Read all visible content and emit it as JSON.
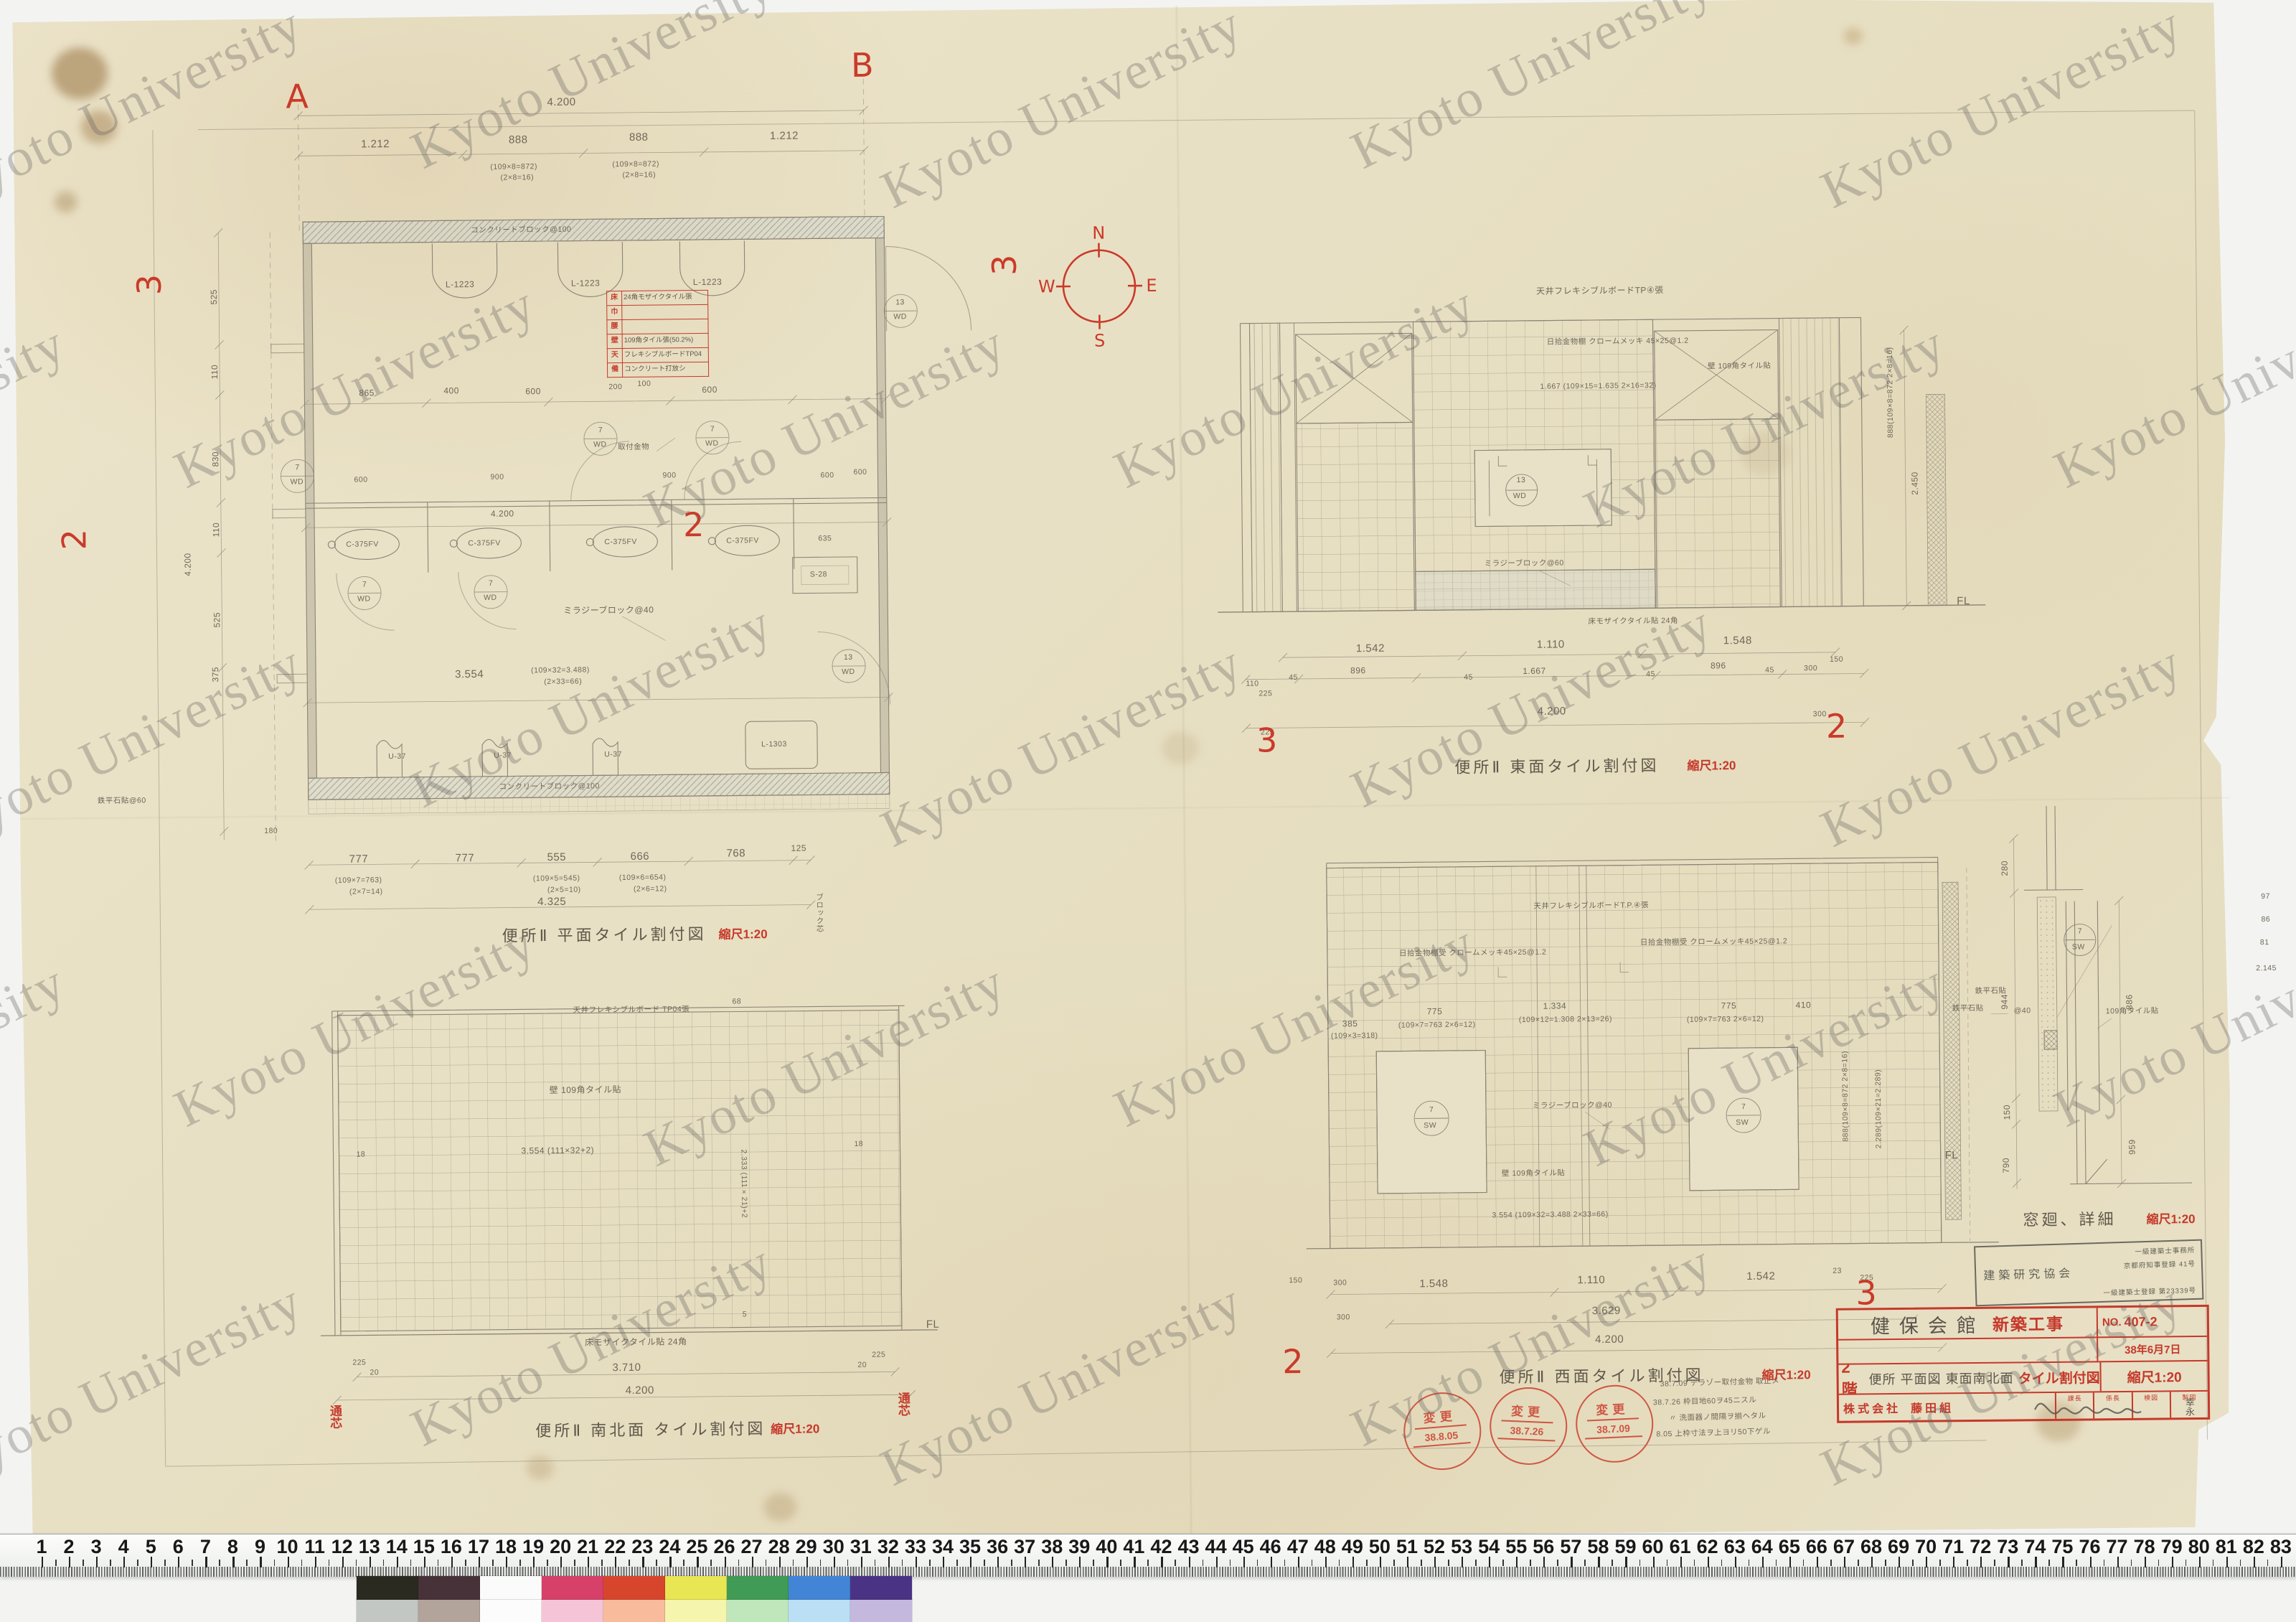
{
  "watermark": {
    "text": "Kyoto University"
  },
  "compass": {
    "n": "N",
    "e": "E",
    "s": "S",
    "w": "W"
  },
  "grid_markers": {
    "a": "A",
    "b": "B",
    "two": "2",
    "three": "3"
  },
  "labels_common": {
    "fl": "FL",
    "scale": "縮尺1:20"
  },
  "plan": {
    "caption": "便所Ⅱ 平面タイル割付図",
    "dims": {
      "t": "4.200",
      "t2": [
        "1.212",
        "888",
        "888",
        "1.212"
      ],
      "calc8": "(109×8=872)",
      "calc8b": "(2×8=16)",
      "b": [
        "777",
        "777",
        "555",
        "666",
        "768",
        "125"
      ],
      "calc7": "(109×7=763)",
      "calc7b": "(2×7=14)",
      "calc5": "(109×5=545)",
      "calc5b": "(2×5=10)",
      "calc6": "(109×6=654)",
      "calc6b": "(2×6=12)",
      "bt": "4.325",
      "l": [
        "525",
        "110",
        "830",
        "110",
        "525"
      ],
      "l375": "375",
      "l180": "180",
      "lt": "4.200",
      "i1": [
        "865",
        "400",
        "600",
        "200",
        "100",
        "600"
      ],
      "i2": [
        "600",
        "900",
        "900",
        "600"
      ],
      "w": "3.554",
      "wc": "(109×32=3.488)",
      "wc2": "(2×33=66)",
      "d635": "635",
      "d600": "600"
    },
    "fx": {
      "sink": "L-1223",
      "stall": "C-375FV",
      "urinal": "U-37",
      "sink2": "L-1303",
      "s28": "S-28",
      "n7": "7",
      "n13": "13",
      "wd": "WD",
      "sw": "SW"
    },
    "notes": {
      "cb100": "コンクリートブロック@100",
      "mb40": "ミラジーブロック@40",
      "kana": "取付金物",
      "core": "ブロック芯",
      "stone": "鉄平石貼@60"
    },
    "schedule": {
      "rows": [
        {
          "h": "床",
          "v": "24角モザイクタイル張"
        },
        {
          "h": "巾",
          "v": ""
        },
        {
          "h": "腰",
          "v": ""
        },
        {
          "h": "壁",
          "v": "109角タイル張(50.2%)"
        },
        {
          "h": "天",
          "v": "フレキシブルボードTP04"
        },
        {
          "h": "備",
          "v": "コンクリート打放シ"
        }
      ]
    }
  },
  "east": {
    "caption": "便所Ⅱ 東面タイル割付図",
    "notes": {
      "ceil": "天井フレキシブルボードTP④張",
      "shelf": "日拾金物棚 クロームメッキ 45×25@1.2",
      "wall": "壁 109角タイル貼",
      "calc": "1.667 (109×15=1.635 2×16=32)",
      "block": "ミラジーブロック@60",
      "floor": "床モザイクタイル貼 24角"
    },
    "dims": {
      "r1": [
        "1.542",
        "1.110",
        "1.548"
      ],
      "r2": [
        "896",
        "1.667",
        "896"
      ],
      "total": "4.200",
      "v": "2.450",
      "vc": "888(109×8=872 2×8=16)",
      "s45": "45",
      "s110": "110",
      "s225": "225",
      "s300": "300",
      "s150": "150"
    }
  },
  "south": {
    "caption": "便所Ⅱ 南北面 タイル割付図",
    "notes": {
      "ceil": "天井フレキシブルボード TP04張",
      "wall": "壁 109角タイル貼",
      "wc": "3.554 (111×32+2)",
      "hc": "2.333 (111×21)+2",
      "floor": "床モザイクタイル貼 24角"
    },
    "dims": {
      "w": "3.710",
      "total": "4.200",
      "s225": "225",
      "s20": "20",
      "s68": "68",
      "s18": "18",
      "s5": "5"
    },
    "tsushin": "通芯"
  },
  "west": {
    "caption": "便所Ⅱ 西面タイル割付図",
    "notes": {
      "ceil": "天井フレキシブルボードT.P.④張",
      "shelf": "日拾金物棚受 クロームメッキ45×25@1.2",
      "wall": "壁 109角タイル貼",
      "block": "ミラジーブロック@40",
      "stone": "鉄平石貼",
      "w775": "775",
      "w775c": "(109×7=763 2×6=12)",
      "w1334": "1.334",
      "w1334c": "(109×12=1.308 2×13=26)",
      "d385": "385",
      "d385c": "(109×3=318)",
      "d410": "410",
      "wc": "3.554 (109×32=3.488 2×33=66)",
      "vc": "888(109×8=872 2×8=16)",
      "vc2": "2.289(109×21=2.289)"
    },
    "dims": {
      "r1": [
        "1.548",
        "1.110",
        "1.542"
      ],
      "mid": "3.629",
      "total": "4.200",
      "s150": "150",
      "s300": "300",
      "s225": "225",
      "s23": "23"
    }
  },
  "detail": {
    "caption": "窓廻、詳細",
    "d": [
      "280",
      "944",
      "150",
      "790",
      "886",
      "959"
    ],
    "at40": "@40",
    "notes": {
      "stone": "鉄平石貼",
      "tile": "109角タイル貼"
    },
    "mn": [
      "97",
      "86",
      "81",
      "2.145"
    ]
  },
  "stamps": {
    "revision": {
      "label": "変更",
      "dates": [
        "38.8.05",
        "38.7.26",
        "38.7.09"
      ]
    },
    "rev_notes": [
      "38.7.09 テラゾー取付金物 取止メ",
      "38.7.26 枠目地60ヲ45ニスル",
      "〃 洗面器ノ間隔ヲ揃ヘタル",
      "8.05 上枠寸法ヲ上ヨリ50下ゲル"
    ],
    "office": {
      "l1": "一級建築士事務所",
      "l2": "京都府知事登録 41号",
      "l3": "建築研究協会",
      "l4": "一級建築士登録 第23339号"
    }
  },
  "title_block": {
    "project": "健保会館",
    "work": "新築工事",
    "no_label": "NO.",
    "no": "407-2",
    "date": "38年6月7日",
    "floor": "2階",
    "subject": "便所 平面図 東面南北面",
    "subject2": "タイル割付図",
    "scale": "縮尺1:20",
    "company": "株式会社",
    "company2": "藤田組",
    "cells": [
      "課長",
      "係長",
      "検図",
      "製図"
    ],
    "sig": "幸永"
  },
  "ruler": {
    "start": 1,
    "end": 83
  },
  "colorbar": {
    "row1": [
      "#2b2a21",
      "#463238",
      "#fbfbfb",
      "#d64069",
      "#d8452d",
      "#e9e654",
      "#3f9b55",
      "#4285d6",
      "#4a3384"
    ],
    "row2": [
      "#c3c7c3",
      "#b2a39b",
      "#fcfcfc",
      "#f5c5d7",
      "#f8bc9c",
      "#f5f5ad",
      "#c0e6bb",
      "#bbdff5",
      "#c4b8df"
    ]
  }
}
